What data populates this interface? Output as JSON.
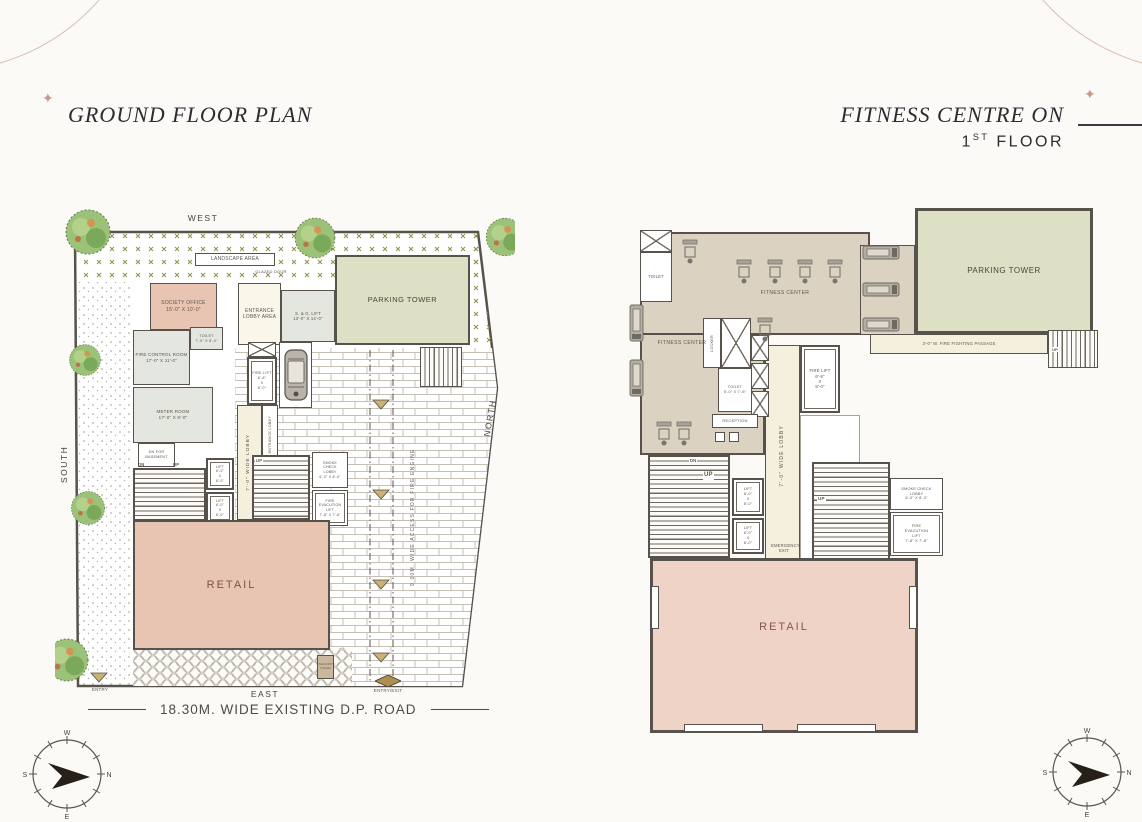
{
  "colors": {
    "accent_brown": "#c59a8b",
    "wall": "#57524b",
    "retail_pink": "#eed3c6",
    "parking_green": "#dde0c4",
    "floor_tan": "#dbd2c2",
    "lobby_cream": "#f5efde"
  },
  "ornament": {
    "star": "✦"
  },
  "titles": {
    "left": "GROUND FLOOR PLAN",
    "right_line1": "FITNESS CENTRE ON",
    "right_num": "1",
    "right_sup": "ST",
    "right_rest": " FLOOR"
  },
  "compass": {
    "w": "W",
    "s": "S",
    "n": "N",
    "e": "E"
  },
  "ground_floor": {
    "directions": {
      "west": "WEST",
      "south": "SOUTH",
      "east": "EAST",
      "north": "NORTH"
    },
    "labels": {
      "landscape_area": "LANDSCAPE AREA",
      "society_office": "SOCIETY OFFICE",
      "society_office_dim": "15'-0\" X 10'-0\"",
      "toilet": "TOILET",
      "toilet_dim": "7'-0\" X 8'-0\"",
      "fire_control_room": "FIRE CONTROL ROOM",
      "fire_control_room_dim": "17'-0\" X 11'-0\"",
      "meter_room": "METER ROOM",
      "meter_room_dim": "17'-0\" X 8'-0\"",
      "glazed_door": "GLAZED DOOR",
      "entrance_lobby_area": "ENTRANCE LOBBY AREA",
      "sg_lift": "S. & G. LIFT",
      "sg_lift_dim": "13'-0\" X 14'-0\"",
      "fire_lift": "FIRE LIFT",
      "fire_lift_w": "6'-8\"",
      "fire_lift_x": "X",
      "fire_lift_h": "8'-0\"",
      "parking_tower": "PARKING TOWER",
      "wide_lobby": "7'-0\"  WIDE  LOBBY",
      "entrance_lobby": "ENTRANCE LOBBY",
      "dn_for_basement": "DN FOR BASEMENT",
      "dn": "DN",
      "up": "UP",
      "lift": "LIFT",
      "lift_w": "8'-0\"",
      "lift_x": "X",
      "lift_h": "8'-0\"",
      "smoke_check_lobby": "SMOKE CHECK LOBBY",
      "smoke_check_dim": "6'-0\" X 8'-0\"",
      "fire_evac_lift": "FIRE EVACUTION LIFT",
      "fire_evac_dim": "7'-8\" X 7'-8\"",
      "retail": "RETAIL",
      "fire_engine_access": "9.00M.  WIDE  ACCESS  FOR  FIRE ENGINE",
      "security_niche": "SECURITY NICHE",
      "entry": "ENTRY",
      "entry_exit": "ENTRY/EXIT",
      "road": "18.30M. WIDE EXISTING D.P. ROAD"
    }
  },
  "first_floor": {
    "labels": {
      "toilet": "TOILET",
      "fitness_center": "FITNESS CENTER",
      "locker": "LOCKER",
      "toilet2": "TOILET",
      "toilet2_dim": "5'-0\" X 7'-6\"",
      "reception": "RECEPTION",
      "fire_lift": "FIRE LIFT",
      "fire_lift_w": "6'-8\"",
      "fire_lift_x": "X",
      "fire_lift_h": "8'-0\"",
      "wide_lobby": "7'-0\"  WIDE  LOBBY",
      "canopy_below": "CANOPY BELOW",
      "parking_tower": "PARKING TOWER",
      "fire_passage": "3'-0\" W. FIRE FIGHTING PASSAGE",
      "up": "UP",
      "dn": "DN",
      "lift": "LIFT",
      "lift_w": "8'-0\"",
      "lift_x": "X",
      "lift_h": "8'-0\"",
      "emergency_exit": "EMERGENCY EXIT",
      "smoke_check_lobby": "SMOKE CHECK LOBBY",
      "smoke_check_dim": "6'-0\" X 8'-0\"",
      "fire_evac_lift": "FIRE EVACUTION LIFT",
      "fire_evac_dim": "7'-8\" X 7'-8\"",
      "retail": "RETAIL"
    }
  }
}
